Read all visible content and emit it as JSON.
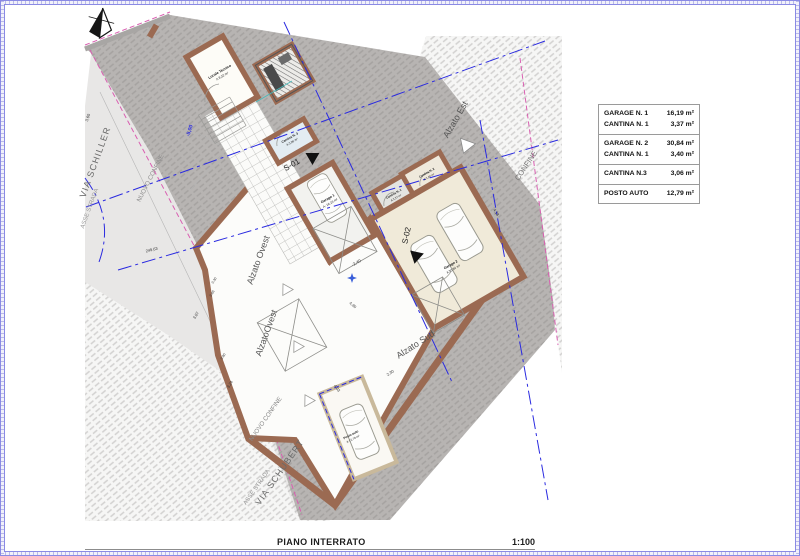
{
  "drawing": {
    "title": "PIANO INTERRATO",
    "scale": "1:100"
  },
  "legend": {
    "groups": [
      {
        "rows": [
          {
            "label": "GARAGE N. 1",
            "value": "16,19 m²"
          },
          {
            "label": "CANTINA N. 1",
            "value": "3,37 m²"
          }
        ]
      },
      {
        "rows": [
          {
            "label": "GARAGE N. 2",
            "value": "30,84 m²"
          },
          {
            "label": "CANTINA N. 1",
            "value": "3,40 m²"
          }
        ]
      },
      {
        "rows": [
          {
            "label": "CANTINA N.3",
            "value": "3,06 m²"
          }
        ]
      },
      {
        "rows": [
          {
            "label": "POSTO AUTO",
            "value": "12,79 m²"
          }
        ]
      }
    ]
  },
  "plan": {
    "rooms": [
      {
        "name": "Locale Tecnico",
        "area": "A 8,32 m²"
      },
      {
        "name": "Cantina N. 3",
        "area": "A 3,06 m²"
      },
      {
        "name": "Garage 1",
        "area": "A: 16,19 m²"
      },
      {
        "name": "Cantina N. 1",
        "area": "A 3,37 m²"
      },
      {
        "name": "Cantina N. 2",
        "area": "A 3,40 m²"
      },
      {
        "name": "Garage 2",
        "area": "A 30,84 m²"
      },
      {
        "name": "Posto auto",
        "area": "A 12,79 m²"
      }
    ],
    "streets": [
      {
        "name": "VIA SCHILLER"
      },
      {
        "name": "VIA SCHUBERT"
      }
    ],
    "axes": [
      {
        "name": "ASSE STRADA"
      },
      {
        "name": "ASSE STRADA"
      }
    ],
    "boundaries": [
      {
        "name": "NUOVO CONFINE"
      },
      {
        "name": "NUOVO CONFINE"
      },
      {
        "name": "CONFINE"
      }
    ],
    "elevation_views": [
      {
        "name": "Alzato Ovest"
      },
      {
        "name": "AlzatoOvest"
      },
      {
        "name": "Alzato Sud"
      },
      {
        "name": "Alzato Est"
      }
    ],
    "section_markers": [
      {
        "id": "S-01"
      },
      {
        "id": "S-02"
      }
    ],
    "spot_levels": [
      {
        "value": "-5,00"
      },
      {
        "value": "-2,40"
      }
    ],
    "dimensions": [
      {
        "value": "3,60"
      },
      {
        "value": "3,07"
      },
      {
        "value": "3,24"
      },
      {
        "value": "249,63"
      },
      {
        "value": "0,30"
      },
      {
        "value": "0,66"
      },
      {
        "value": "0,80"
      },
      {
        "value": "4,90"
      },
      {
        "value": "4,03"
      },
      {
        "value": "2,30"
      },
      {
        "value": "4,18"
      }
    ]
  },
  "colors": {
    "wall": "#9b6a52",
    "axis_blue": "#2a2ae0",
    "confine_magenta": "#d95fb1",
    "road_dark": "#b7b4b2",
    "paper": "#ffffff"
  }
}
